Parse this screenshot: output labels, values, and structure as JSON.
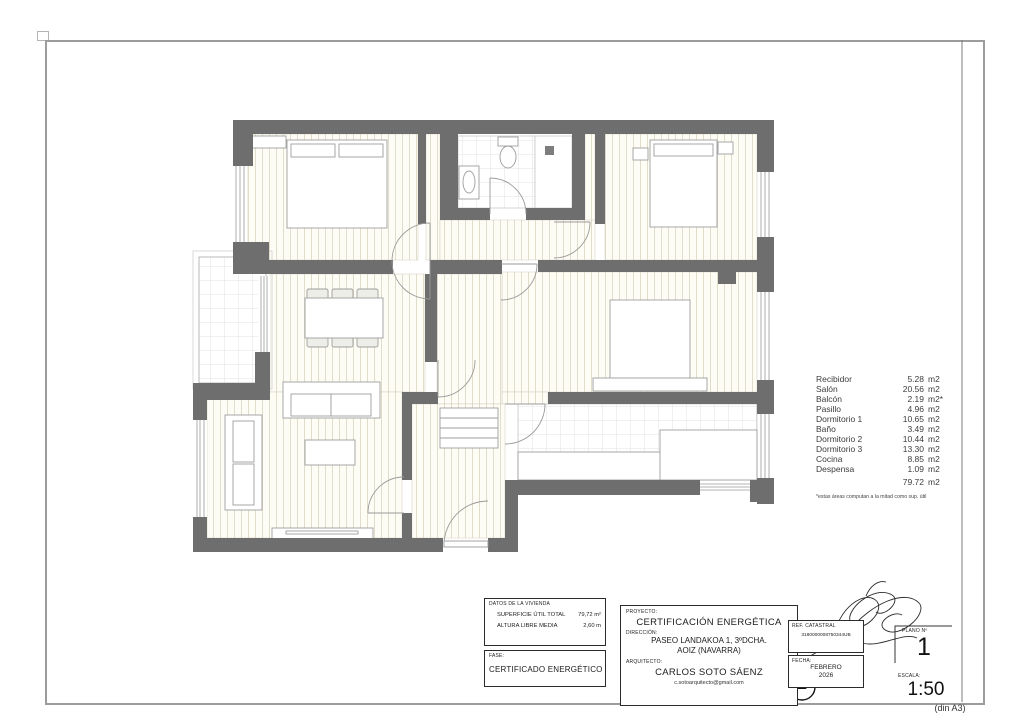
{
  "areas": {
    "items": [
      {
        "name": "Recibidor",
        "value": "5.28",
        "unit": "m2"
      },
      {
        "name": "Salón",
        "value": "20.56",
        "unit": "m2"
      },
      {
        "name": "Balcón",
        "value": "2.19",
        "unit": "m2*"
      },
      {
        "name": "Pasillo",
        "value": "4.96",
        "unit": "m2"
      },
      {
        "name": "Dormitorio 1",
        "value": "10.65",
        "unit": "m2"
      },
      {
        "name": "Baño",
        "value": "3.49",
        "unit": "m2"
      },
      {
        "name": "Dormitorio 2",
        "value": "10.44",
        "unit": "m2"
      },
      {
        "name": "Dormitorio 3",
        "value": "13.30",
        "unit": "m2"
      },
      {
        "name": "Cocina",
        "value": "8.85",
        "unit": "m2"
      },
      {
        "name": "Despensa",
        "value": "1.09",
        "unit": "m2"
      }
    ],
    "total_value": "79.72",
    "total_unit": "m2",
    "footnote": "*estas áreas computan a la mitad como sup. útil"
  },
  "titleblock": {
    "datos": {
      "label": "DATOS DE LA VIVIENDA",
      "superficie_label": "SUPERFICIE ÚTIL TOTAL",
      "superficie_value": "79,72 m²",
      "altura_label": "ALTURA LIBRE MEDIA",
      "altura_value": "2,60 m"
    },
    "fase": {
      "label": "FASE:",
      "value": "CERTIFICADO ENERGÉTICO"
    },
    "proyecto": {
      "label": "PROYECTO:",
      "value": "CERTIFICACIÓN ENERGÉTICA"
    },
    "direccion": {
      "label": "DIRECCIÓN:",
      "line1": "PASEO LANDAKOA 1, 3ºDCHA.",
      "line2": "AOIZ (NAVARRA)"
    },
    "arquitecto": {
      "label": "ARQUITECTO:",
      "name": "CARLOS SOTO SÁENZ",
      "email": "c.sotoarquitecto@gmail.com"
    },
    "ref_catastral": {
      "label": "REF. CATASTRAL",
      "value": "3180000008750344UB"
    },
    "fecha": {
      "label": "FECHA:",
      "line1": "FEBRERO",
      "line2": "2026"
    },
    "plano": {
      "label": "PLANO Nº",
      "value": "1"
    },
    "escala": {
      "label": "ESCALA:",
      "value": "1:50"
    },
    "din": "(din A3)"
  },
  "colors": {
    "wall": "#6e6e6e",
    "floor_stripe": "#e0ddcb",
    "tile_line": "#dadada",
    "frame": "#9c9c9c"
  }
}
